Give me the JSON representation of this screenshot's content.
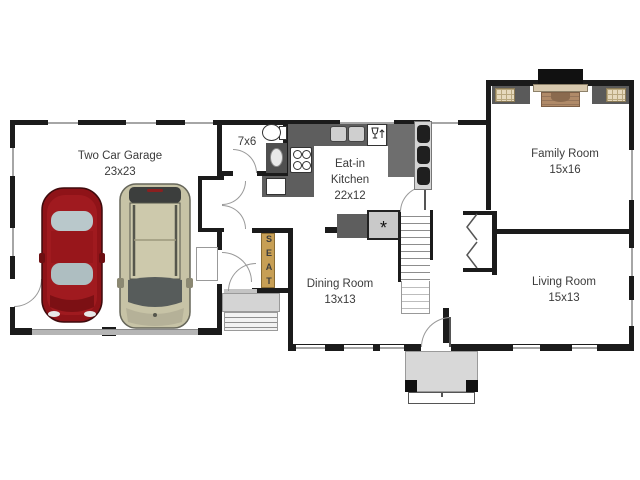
{
  "rooms": {
    "garage": {
      "name": "Two Car Garage",
      "size": "23x23"
    },
    "bathroom": {
      "size": "7x6"
    },
    "kitchen": {
      "name_line1": "Eat-in",
      "name_line2": "Kitchen",
      "size": "22x12"
    },
    "family_room": {
      "name": "Family Room",
      "size": "15x16"
    },
    "dining_room": {
      "name": "Dining Room",
      "size": "13x13"
    },
    "living_room": {
      "name": "Living Room",
      "size": "15x13"
    }
  },
  "fixtures": {
    "seat_label": "SEAT",
    "refrigerator_symbol": "*"
  },
  "colors": {
    "wall": "#1b1b1b",
    "window": "#a6a6a6",
    "counter": "#5e5e5e",
    "porch": "#d8d8d8",
    "garage_door": "#b5b5b5",
    "seat_bench": "#c79f55",
    "car_red": "#8f1318",
    "car_tan": "#c7c3a6",
    "fireplace_brick": "#b08a68",
    "fireplace_mantel": "#d8c9ae",
    "builtin_tan": "#e6d9bd"
  }
}
